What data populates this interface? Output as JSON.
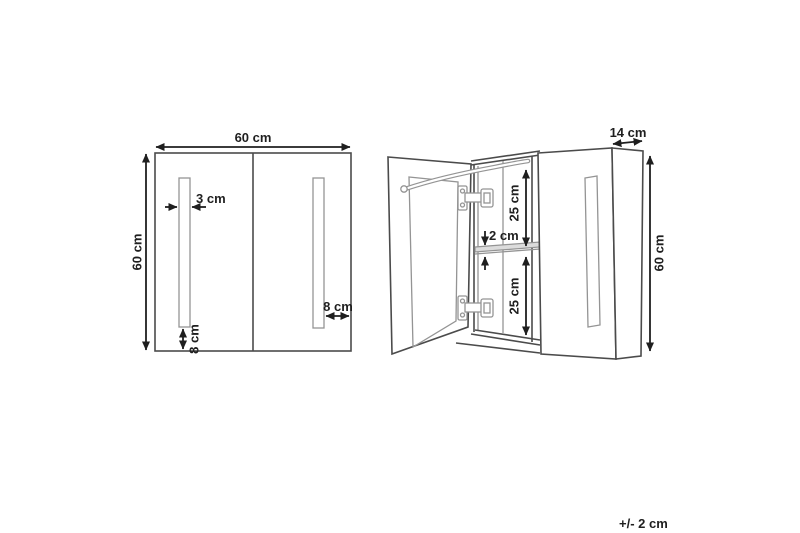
{
  "colors": {
    "line_dark": "#1f1f1f",
    "line_medium": "#4b4b4b",
    "line_light": "#949494",
    "background": "#ffffff",
    "shelf_fill": "#dcdcdc"
  },
  "front_view": {
    "width_label": "60 cm",
    "height_label": "60 cm",
    "led_strip_width_label": "3 cm",
    "led_strip_bottom_offset_label": "8 cm",
    "led_strip_side_offset_label": "8 cm"
  },
  "side_view": {
    "depth_label": "14 cm",
    "height_label": "60 cm",
    "upper_compartment_label": "25 cm",
    "shelf_thickness_label": "2 cm",
    "lower_compartment_label": "25 cm"
  },
  "tolerance_label": "+/- 2 cm"
}
